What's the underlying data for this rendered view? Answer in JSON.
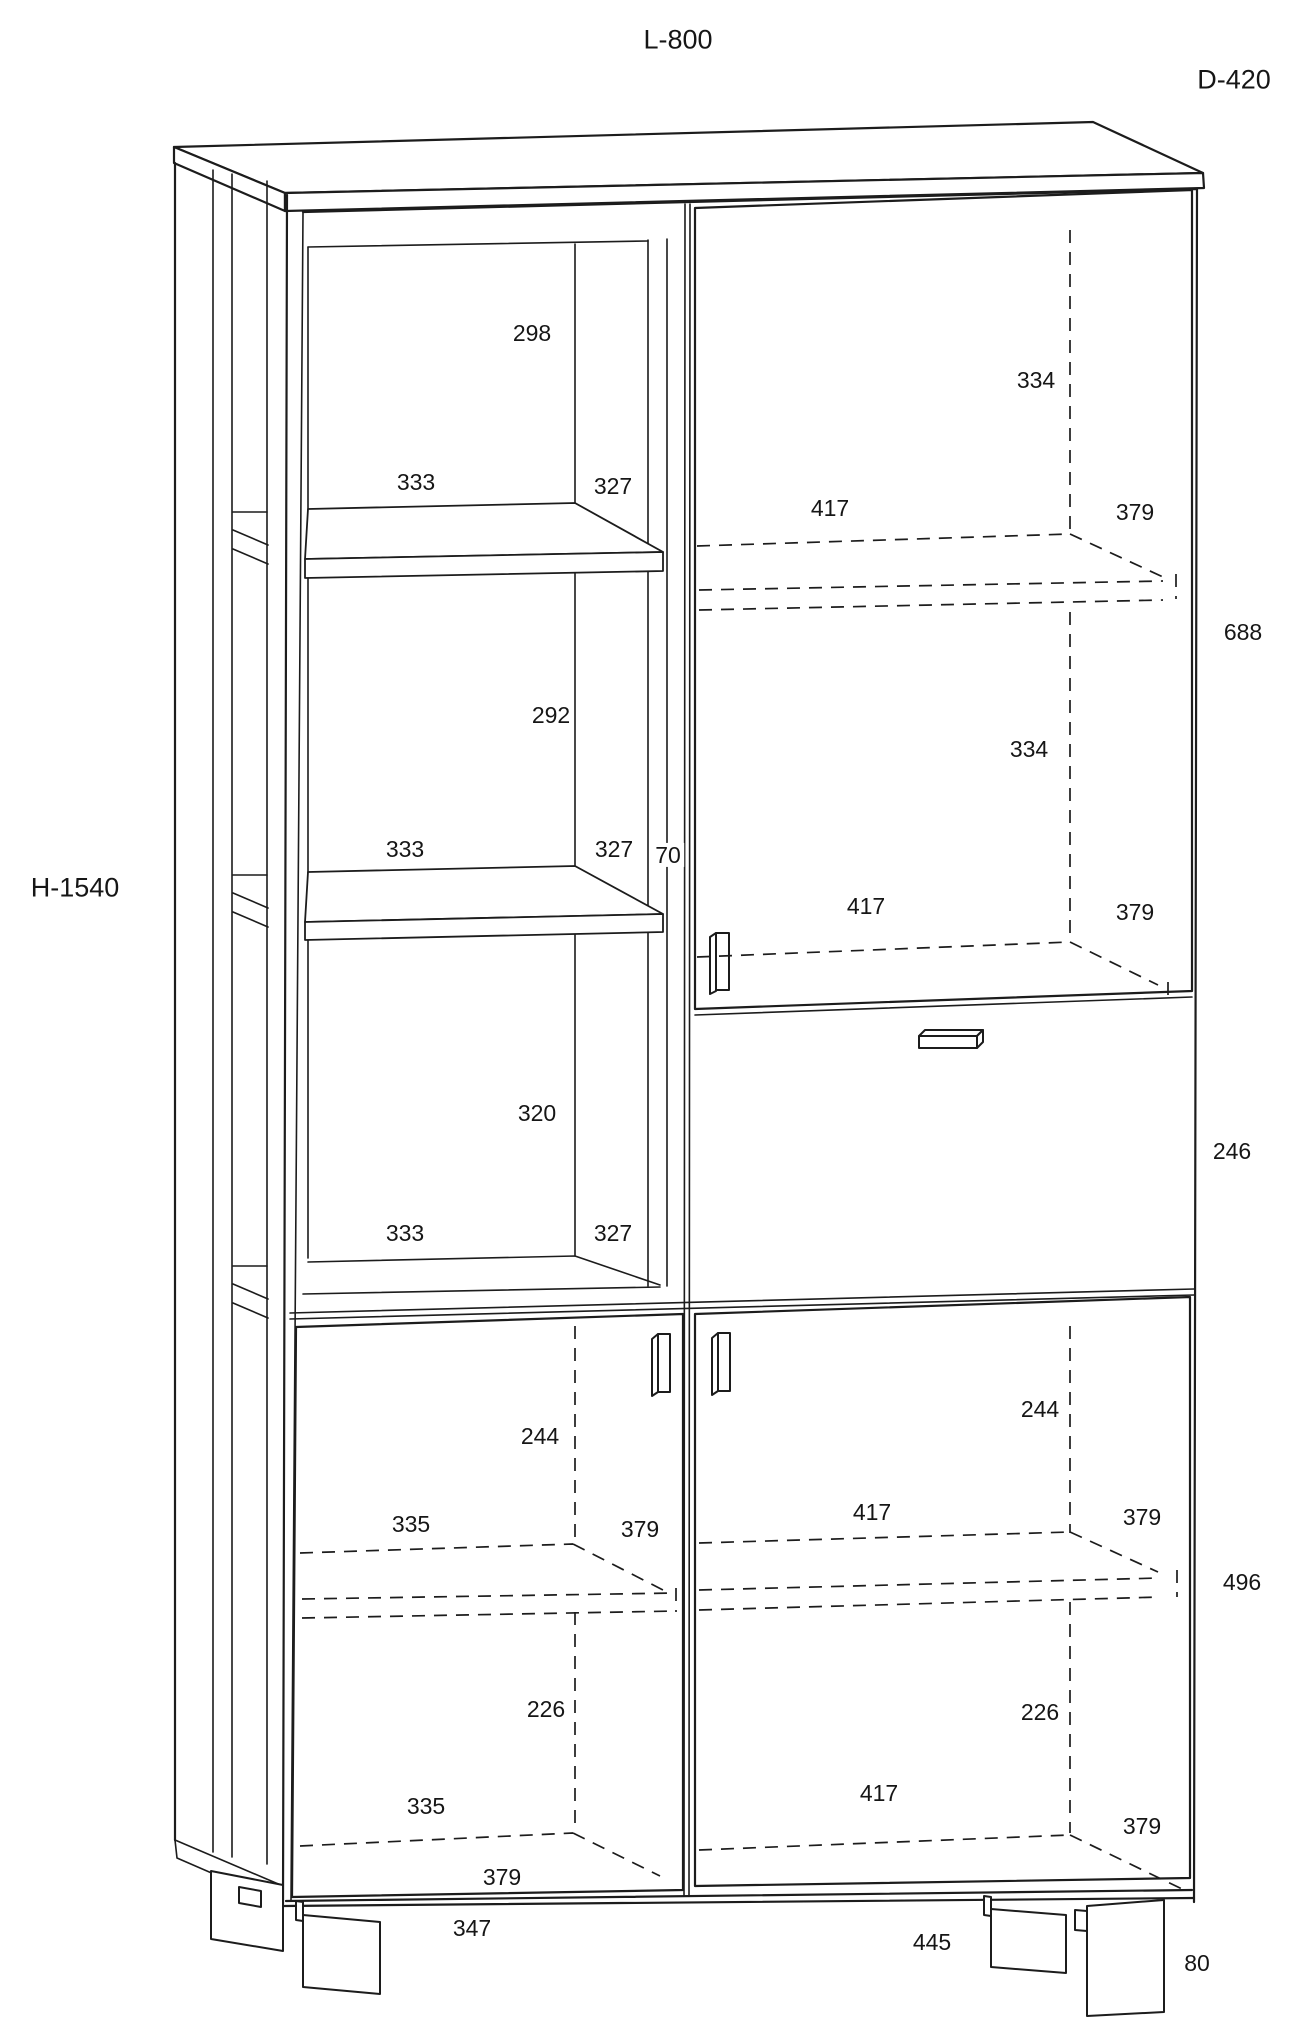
{
  "drawing": {
    "type": "furniture-technical-drawing",
    "overall": {
      "length": "L-800",
      "depth": "D-420",
      "height": "H-1540"
    },
    "overall_dimensions_mm": {
      "length": 800,
      "depth": 420,
      "height": 1540
    },
    "section_dimensions_mm": {
      "upper_left_open_shelves": {
        "compartment_heights": [
          298,
          292,
          320
        ],
        "inner_widths": [
          333,
          333,
          333
        ],
        "shelf_depths": [
          327,
          327,
          327
        ],
        "center_rail_width": 70
      },
      "upper_right_door": {
        "compartment_heights": [
          334,
          334
        ],
        "inner_widths": [
          417,
          417
        ],
        "shelf_depths": [
          379,
          379
        ],
        "total_inner_height": 688
      },
      "drawer": {
        "height": 246
      },
      "bottom_left_door": {
        "above_shelf_height": 244,
        "below_shelf_height": 226,
        "inner_widths": [
          335,
          335
        ],
        "shelf_depths": [
          379,
          379
        ]
      },
      "bottom_right_door": {
        "above_shelf_height": 244,
        "below_shelf_height": 226,
        "inner_widths": [
          417,
          417
        ],
        "shelf_depths": [
          379,
          379
        ],
        "total_inner_height": 496
      },
      "base": {
        "foot_spacing_left": 347,
        "foot_spacing_right": 445,
        "foot_height": 80
      }
    },
    "labels": [
      {
        "name": "dim-298",
        "text": "298",
        "x": 532,
        "y": 333
      },
      {
        "name": "dim-333-1",
        "text": "333",
        "x": 416,
        "y": 482
      },
      {
        "name": "dim-327-1",
        "text": "327",
        "x": 613,
        "y": 486
      },
      {
        "name": "dim-334-1",
        "text": "334",
        "x": 1036,
        "y": 380
      },
      {
        "name": "dim-417-1",
        "text": "417",
        "x": 830,
        "y": 508
      },
      {
        "name": "dim-379-1",
        "text": "379",
        "x": 1135,
        "y": 512
      },
      {
        "name": "dim-688",
        "text": "688",
        "x": 1243,
        "y": 632
      },
      {
        "name": "dim-292",
        "text": "292",
        "x": 551,
        "y": 715
      },
      {
        "name": "dim-333-2",
        "text": "333",
        "x": 405,
        "y": 849
      },
      {
        "name": "dim-327-2",
        "text": "327",
        "x": 614,
        "y": 849
      },
      {
        "name": "dim-70",
        "text": "70",
        "x": 668,
        "y": 855
      },
      {
        "name": "dim-334-2",
        "text": "334",
        "x": 1029,
        "y": 749
      },
      {
        "name": "dim-417-2",
        "text": "417",
        "x": 866,
        "y": 906
      },
      {
        "name": "dim-379-2",
        "text": "379",
        "x": 1135,
        "y": 912
      },
      {
        "name": "dim-320",
        "text": "320",
        "x": 537,
        "y": 1113
      },
      {
        "name": "dim-333-3",
        "text": "333",
        "x": 405,
        "y": 1233
      },
      {
        "name": "dim-327-3",
        "text": "327",
        "x": 613,
        "y": 1233
      },
      {
        "name": "dim-246",
        "text": "246",
        "x": 1232,
        "y": 1151
      },
      {
        "name": "dim-244-left",
        "text": "244",
        "x": 540,
        "y": 1436
      },
      {
        "name": "dim-244-right",
        "text": "244",
        "x": 1040,
        "y": 1409
      },
      {
        "name": "dim-335-1",
        "text": "335",
        "x": 411,
        "y": 1524
      },
      {
        "name": "dim-379-3",
        "text": "379",
        "x": 640,
        "y": 1529
      },
      {
        "name": "dim-417-3",
        "text": "417",
        "x": 872,
        "y": 1512
      },
      {
        "name": "dim-379-4",
        "text": "379",
        "x": 1142,
        "y": 1517
      },
      {
        "name": "dim-496",
        "text": "496",
        "x": 1242,
        "y": 1582
      },
      {
        "name": "dim-226-left",
        "text": "226",
        "x": 546,
        "y": 1709
      },
      {
        "name": "dim-226-right",
        "text": "226",
        "x": 1040,
        "y": 1712
      },
      {
        "name": "dim-335-2",
        "text": "335",
        "x": 426,
        "y": 1806
      },
      {
        "name": "dim-379-5",
        "text": "379",
        "x": 502,
        "y": 1877
      },
      {
        "name": "dim-417-4",
        "text": "417",
        "x": 879,
        "y": 1793
      },
      {
        "name": "dim-379-6",
        "text": "379",
        "x": 1142,
        "y": 1826
      },
      {
        "name": "dim-347",
        "text": "347",
        "x": 472,
        "y": 1928
      },
      {
        "name": "dim-445",
        "text": "445",
        "x": 932,
        "y": 1942
      },
      {
        "name": "dim-80",
        "text": "80",
        "x": 1197,
        "y": 1963
      }
    ],
    "colors": {
      "line": "#1c1c1c",
      "background": "#ffffff",
      "text": "#161616"
    }
  }
}
